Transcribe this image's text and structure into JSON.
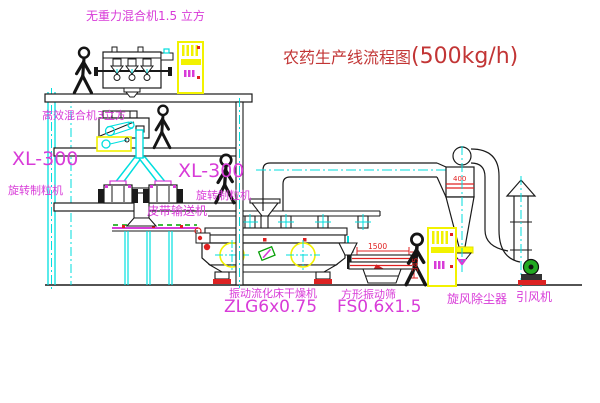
{
  "title": {
    "prefix": "农药生产线流程图",
    "capacity": "(500kg/h)"
  },
  "labels": {
    "top_mixer": "无重力混合机1.5 立方",
    "mixer2": "高效混合机3立方",
    "granulator_left_model": "XL-300",
    "granulator_left_name": "旋转制粒机",
    "granulator_mid_model": "XL-300",
    "granulator_mid_name": "旋转制粒机",
    "belt": "皮带输送机",
    "dryer_name": "振动流化床干燥机",
    "dryer_model": "ZLG6x0.75",
    "screen_name": "方形振动筛",
    "screen_model": "FS0.6x1.5",
    "cyclone": "旋风除尘器",
    "fan": "引风机"
  },
  "dimensions": {
    "screen_length": "1500",
    "screen_height": "345",
    "cyclone_dia": "400"
  },
  "colors": {
    "line_cyan": "#00dede",
    "label_magenta": "#d83bd8",
    "title_red": "#c23535",
    "dim_red": "#e02020",
    "cabinet_yellow": "#f2f200",
    "belt_green": "#00a000",
    "base_red": "#dd2222",
    "outline_black": "#1a1a1a"
  }
}
